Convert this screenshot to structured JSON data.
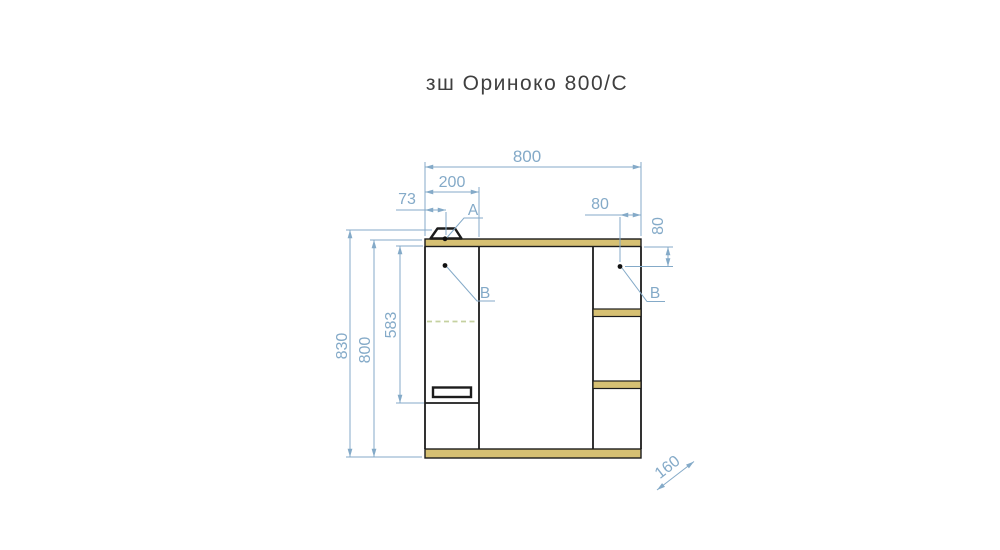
{
  "title": "зш Ориноко 800/С",
  "colors": {
    "dimension_blue": "#84aac8",
    "wood_fill": "#d6c073",
    "outline_black": "#1c1c1c",
    "hidden_line_green": "#c5d1a0",
    "title_text": "#3f3f3f"
  },
  "dimensions": {
    "overall_width": "800",
    "left_door_width": "200",
    "lamp_offset": "73",
    "fitting_inset_horizontal": "80",
    "fitting_inset_vertical": "80",
    "overall_height": "830",
    "body_height": "800",
    "left_door_height": "583",
    "depth": "160"
  },
  "labels": {
    "detail_a": "A",
    "detail_b_left": "B",
    "detail_b_right": "B"
  }
}
